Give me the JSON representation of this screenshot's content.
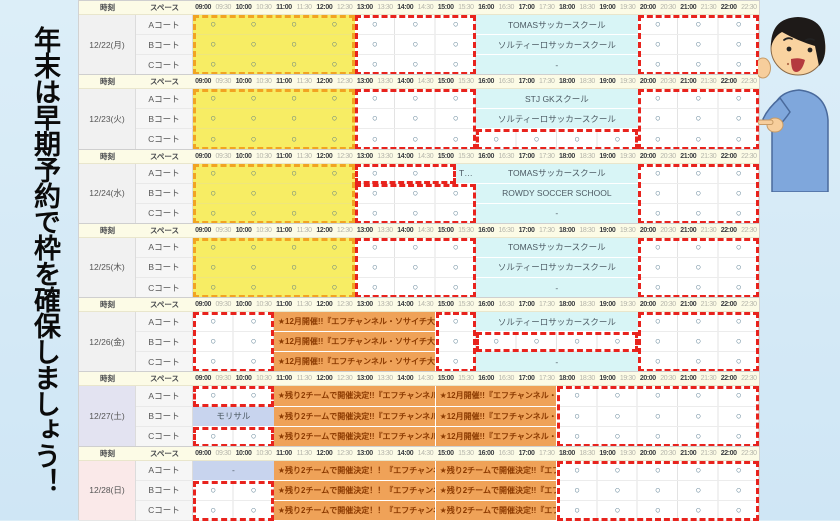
{
  "page": {
    "vertical_message": "年末は早期予約で枠を確保しましょう！"
  },
  "legend": {
    "available_mark": "○"
  },
  "colors": {
    "highlight_red_dash": "#E8231D",
    "highlight_orange_dash": "#F1A422",
    "morning_yellow": "#F7ED64",
    "school_cyan": "#D8F5F6",
    "event_orange": "#EFA258",
    "booking_lavender": "#C8D4EE",
    "mark_blue": "#4D7389"
  },
  "table": {
    "headers": {
      "time_label": "時刻",
      "space_label": "スペース"
    },
    "time_slots": [
      "09:00",
      "09:30",
      "10:00",
      "10:30",
      "11:00",
      "11:30",
      "12:00",
      "12:30",
      "13:00",
      "13:30",
      "14:00",
      "14:30",
      "15:00",
      "15:30",
      "16:00",
      "16:30",
      "17:00",
      "17:30",
      "18:00",
      "18:30",
      "19:00",
      "19:30",
      "20:00",
      "20:30",
      "21:00",
      "21:30",
      "22:00",
      "22:30"
    ],
    "courts": [
      "Aコート",
      "Bコート",
      "Cコート"
    ],
    "days": [
      {
        "date": "12/22(月)",
        "type": "weekday",
        "rows": [
          {
            "segs": [
              {
                "s": 0,
                "e": 8,
                "bg": "yellow",
                "c": "circles"
              },
              {
                "s": 8,
                "e": 14,
                "bg": "white",
                "c": "circles"
              },
              {
                "s": 14,
                "e": 22,
                "bg": "cyan",
                "t": "TOMASサッカースクール"
              },
              {
                "s": 22,
                "e": 28,
                "bg": "white",
                "c": "circles"
              }
            ]
          },
          {
            "segs": [
              {
                "s": 0,
                "e": 8,
                "bg": "yellow",
                "c": "circles"
              },
              {
                "s": 8,
                "e": 14,
                "bg": "white",
                "c": "circles"
              },
              {
                "s": 14,
                "e": 22,
                "bg": "cyan",
                "t": "ソルティーロサッカースクール"
              },
              {
                "s": 22,
                "e": 28,
                "bg": "white",
                "c": "circles"
              }
            ]
          },
          {
            "segs": [
              {
                "s": 0,
                "e": 8,
                "bg": "yellow",
                "c": "circles"
              },
              {
                "s": 8,
                "e": 14,
                "bg": "white",
                "c": "circles"
              },
              {
                "s": 14,
                "e": 22,
                "bg": "cyan",
                "t": "-"
              },
              {
                "s": 22,
                "e": 28,
                "bg": "white",
                "c": "circles"
              }
            ]
          }
        ],
        "boxes": [
          {
            "s": 0,
            "e": 8,
            "rows": [
              0,
              3
            ],
            "color": "orange"
          },
          {
            "s": 8,
            "e": 14,
            "rows": [
              0,
              3
            ],
            "color": "red"
          },
          {
            "s": 22,
            "e": 28,
            "rows": [
              0,
              3
            ],
            "color": "red"
          }
        ]
      },
      {
        "date": "12/23(火)",
        "type": "weekday",
        "rows": [
          {
            "segs": [
              {
                "s": 0,
                "e": 8,
                "bg": "yellow",
                "c": "circles"
              },
              {
                "s": 8,
                "e": 14,
                "bg": "white",
                "c": "circles"
              },
              {
                "s": 14,
                "e": 22,
                "bg": "cyan",
                "t": "STJ GKスクール"
              },
              {
                "s": 22,
                "e": 28,
                "bg": "white",
                "c": "circles"
              }
            ]
          },
          {
            "segs": [
              {
                "s": 0,
                "e": 8,
                "bg": "yellow",
                "c": "circles"
              },
              {
                "s": 8,
                "e": 14,
                "bg": "white",
                "c": "circles"
              },
              {
                "s": 14,
                "e": 22,
                "bg": "cyan",
                "t": "ソルティーロサッカースクール"
              },
              {
                "s": 22,
                "e": 28,
                "bg": "white",
                "c": "circles"
              }
            ]
          },
          {
            "segs": [
              {
                "s": 0,
                "e": 8,
                "bg": "yellow",
                "c": "circles"
              },
              {
                "s": 8,
                "e": 14,
                "bg": "white",
                "c": "circles"
              },
              {
                "s": 14,
                "e": 22,
                "bg": "white",
                "c": "circles"
              },
              {
                "s": 22,
                "e": 28,
                "bg": "white",
                "c": "circles"
              }
            ]
          }
        ],
        "boxes": [
          {
            "s": 0,
            "e": 8,
            "rows": [
              0,
              3
            ],
            "color": "orange"
          },
          {
            "s": 8,
            "e": 14,
            "rows": [
              0,
              3
            ],
            "color": "red"
          },
          {
            "s": 14,
            "e": 22,
            "rows": [
              2,
              3
            ],
            "color": "red"
          },
          {
            "s": 22,
            "e": 28,
            "rows": [
              0,
              3
            ],
            "color": "red"
          }
        ]
      },
      {
        "date": "12/24(水)",
        "type": "weekday",
        "rows": [
          {
            "segs": [
              {
                "s": 0,
                "e": 8,
                "bg": "yellow",
                "c": "circles"
              },
              {
                "s": 8,
                "e": 13,
                "bg": "white",
                "c": "circles"
              },
              {
                "s": 13,
                "e": 14,
                "bg": "cyan",
                "t": "T…"
              },
              {
                "s": 14,
                "e": 22,
                "bg": "cyan",
                "t": "TOMASサッカースクール"
              },
              {
                "s": 22,
                "e": 28,
                "bg": "white",
                "c": "circles"
              }
            ]
          },
          {
            "segs": [
              {
                "s": 0,
                "e": 8,
                "bg": "yellow",
                "c": "circles"
              },
              {
                "s": 8,
                "e": 14,
                "bg": "white",
                "c": "circles"
              },
              {
                "s": 14,
                "e": 22,
                "bg": "cyan",
                "t": "ROWDY SOCCER SCHOOL"
              },
              {
                "s": 22,
                "e": 28,
                "bg": "white",
                "c": "circles"
              }
            ]
          },
          {
            "segs": [
              {
                "s": 0,
                "e": 8,
                "bg": "yellow",
                "c": "circles"
              },
              {
                "s": 8,
                "e": 14,
                "bg": "white",
                "c": "circles"
              },
              {
                "s": 14,
                "e": 22,
                "bg": "cyan",
                "t": "-"
              },
              {
                "s": 22,
                "e": 28,
                "bg": "white",
                "c": "circles"
              }
            ]
          }
        ],
        "boxes": [
          {
            "s": 0,
            "e": 8,
            "rows": [
              0,
              3
            ],
            "color": "orange"
          },
          {
            "s": 8,
            "e": 13,
            "rows": [
              0,
              1
            ],
            "color": "red"
          },
          {
            "s": 8,
            "e": 14,
            "rows": [
              1,
              3
            ],
            "color": "red"
          },
          {
            "s": 22,
            "e": 28,
            "rows": [
              0,
              3
            ],
            "color": "red"
          }
        ]
      },
      {
        "date": "12/25(木)",
        "type": "weekday",
        "rows": [
          {
            "segs": [
              {
                "s": 0,
                "e": 8,
                "bg": "yellow",
                "c": "circles"
              },
              {
                "s": 8,
                "e": 14,
                "bg": "white",
                "c": "circles"
              },
              {
                "s": 14,
                "e": 22,
                "bg": "cyan",
                "t": "TOMASサッカースクール"
              },
              {
                "s": 22,
                "e": 28,
                "bg": "white",
                "c": "circles"
              }
            ]
          },
          {
            "segs": [
              {
                "s": 0,
                "e": 8,
                "bg": "yellow",
                "c": "circles"
              },
              {
                "s": 8,
                "e": 14,
                "bg": "white",
                "c": "circles"
              },
              {
                "s": 14,
                "e": 22,
                "bg": "cyan",
                "t": "ソルティーロサッカースクール"
              },
              {
                "s": 22,
                "e": 28,
                "bg": "white",
                "c": "circles"
              }
            ]
          },
          {
            "segs": [
              {
                "s": 0,
                "e": 8,
                "bg": "yellow",
                "c": "circles"
              },
              {
                "s": 8,
                "e": 14,
                "bg": "white",
                "c": "circles"
              },
              {
                "s": 14,
                "e": 22,
                "bg": "cyan",
                "t": "-"
              },
              {
                "s": 22,
                "e": 28,
                "bg": "white",
                "c": "circles"
              }
            ]
          }
        ],
        "boxes": [
          {
            "s": 0,
            "e": 8,
            "rows": [
              0,
              3
            ],
            "color": "orange"
          },
          {
            "s": 8,
            "e": 14,
            "rows": [
              0,
              3
            ],
            "color": "red"
          },
          {
            "s": 22,
            "e": 28,
            "rows": [
              0,
              3
            ],
            "color": "red"
          }
        ]
      },
      {
        "date": "12/26(金)",
        "type": "weekday",
        "rows": [
          {
            "segs": [
              {
                "s": 0,
                "e": 4,
                "bg": "white",
                "c": "circles"
              },
              {
                "s": 4,
                "e": 12,
                "bg": "orange",
                "t": "★12月開催!!『エフチャンネル・ソサイチ大会!!…"
              },
              {
                "s": 12,
                "e": 14,
                "bg": "white",
                "c": "circles"
              },
              {
                "s": 14,
                "e": 22,
                "bg": "cyan",
                "t": "ソルティーロサッカースクール"
              },
              {
                "s": 22,
                "e": 28,
                "bg": "white",
                "c": "circles"
              }
            ]
          },
          {
            "segs": [
              {
                "s": 0,
                "e": 4,
                "bg": "white",
                "c": "circles"
              },
              {
                "s": 4,
                "e": 12,
                "bg": "orange",
                "t": "★12月開催!!『エフチャンネル・ソサイチ大会!!…"
              },
              {
                "s": 12,
                "e": 14,
                "bg": "white",
                "c": "circles"
              },
              {
                "s": 14,
                "e": 22,
                "bg": "white",
                "c": "circles"
              },
              {
                "s": 22,
                "e": 28,
                "bg": "white",
                "c": "circles"
              }
            ]
          },
          {
            "segs": [
              {
                "s": 0,
                "e": 4,
                "bg": "white",
                "c": "circles"
              },
              {
                "s": 4,
                "e": 12,
                "bg": "orange",
                "t": "★12月開催!!『エフチャンネル・ソサイチ大会!!…"
              },
              {
                "s": 12,
                "e": 14,
                "bg": "white",
                "c": "circles"
              },
              {
                "s": 14,
                "e": 22,
                "bg": "cyan",
                "t": "-"
              },
              {
                "s": 22,
                "e": 28,
                "bg": "white",
                "c": "circles"
              }
            ]
          }
        ],
        "boxes": [
          {
            "s": 0,
            "e": 4,
            "rows": [
              0,
              3
            ],
            "color": "red"
          },
          {
            "s": 12,
            "e": 14,
            "rows": [
              0,
              3
            ],
            "color": "red"
          },
          {
            "s": 14,
            "e": 22,
            "rows": [
              1,
              2
            ],
            "color": "red"
          },
          {
            "s": 22,
            "e": 28,
            "rows": [
              0,
              3
            ],
            "color": "red"
          }
        ]
      },
      {
        "date": "12/27(土)",
        "type": "sat",
        "rows": [
          {
            "segs": [
              {
                "s": 0,
                "e": 4,
                "bg": "white",
                "c": "circles"
              },
              {
                "s": 4,
                "e": 12,
                "bg": "orange",
                "t": "★残り2チームで開催決定!!『エフチャンネル・…"
              },
              {
                "s": 12,
                "e": 18,
                "bg": "orange",
                "t": "★12月開催!!『エフチャンネル・ソ…"
              },
              {
                "s": 18,
                "e": 28,
                "bg": "white",
                "c": "circles"
              }
            ]
          },
          {
            "segs": [
              {
                "s": 0,
                "e": 4,
                "bg": "lav",
                "t": "モリサル"
              },
              {
                "s": 4,
                "e": 12,
                "bg": "orange",
                "t": "★残り2チームで開催決定!!『エフチャンネル・…"
              },
              {
                "s": 12,
                "e": 18,
                "bg": "orange",
                "t": "★12月開催!!『エフチャンネル・ソ…"
              },
              {
                "s": 18,
                "e": 28,
                "bg": "white",
                "c": "circles"
              }
            ]
          },
          {
            "segs": [
              {
                "s": 0,
                "e": 4,
                "bg": "white",
                "c": "circles"
              },
              {
                "s": 4,
                "e": 12,
                "bg": "orange",
                "t": "★残り2チームで開催決定!!『エフチャンネル・…"
              },
              {
                "s": 12,
                "e": 18,
                "bg": "orange",
                "t": "★12月開催!!『エフチャンネル・ソ…"
              },
              {
                "s": 18,
                "e": 28,
                "bg": "white",
                "c": "circles"
              }
            ]
          }
        ],
        "boxes": [
          {
            "s": 0,
            "e": 4,
            "rows": [
              0,
              1
            ],
            "color": "red"
          },
          {
            "s": 0,
            "e": 4,
            "rows": [
              2,
              3
            ],
            "color": "red"
          },
          {
            "s": 18,
            "e": 28,
            "rows": [
              0,
              3
            ],
            "color": "red"
          }
        ]
      },
      {
        "date": "12/28(日)",
        "type": "sun",
        "rows": [
          {
            "segs": [
              {
                "s": 0,
                "e": 4,
                "bg": "lav",
                "t": "-"
              },
              {
                "s": 4,
                "e": 12,
                "bg": "orange",
                "t": "★残り2チームで開催決定！！『エフチャンネル…"
              },
              {
                "s": 12,
                "e": 18,
                "bg": "orange",
                "t": "★残り2チームで開催決定!!『エフ…"
              },
              {
                "s": 18,
                "e": 28,
                "bg": "white",
                "c": "circles"
              }
            ]
          },
          {
            "segs": [
              {
                "s": 0,
                "e": 4,
                "bg": "white",
                "c": "circles"
              },
              {
                "s": 4,
                "e": 12,
                "bg": "orange",
                "t": "★残り2チームで開催決定！！『エフチャンネル…"
              },
              {
                "s": 12,
                "e": 18,
                "bg": "orange",
                "t": "★残り2チームで開催決定!!『エフ…"
              },
              {
                "s": 18,
                "e": 28,
                "bg": "white",
                "c": "circles"
              }
            ]
          },
          {
            "segs": [
              {
                "s": 0,
                "e": 4,
                "bg": "white",
                "c": "circles"
              },
              {
                "s": 4,
                "e": 12,
                "bg": "orange",
                "t": "★残り2チームで開催決定！！『エフチャンネル…"
              },
              {
                "s": 12,
                "e": 18,
                "bg": "orange",
                "t": "★残り2チームで開催決定!!『エフ…"
              },
              {
                "s": 18,
                "e": 28,
                "bg": "white",
                "c": "circles"
              }
            ]
          }
        ],
        "boxes": [
          {
            "s": 0,
            "e": 4,
            "rows": [
              1,
              3
            ],
            "color": "red"
          },
          {
            "s": 18,
            "e": 28,
            "rows": [
              0,
              3
            ],
            "color": "red"
          }
        ]
      }
    ]
  }
}
